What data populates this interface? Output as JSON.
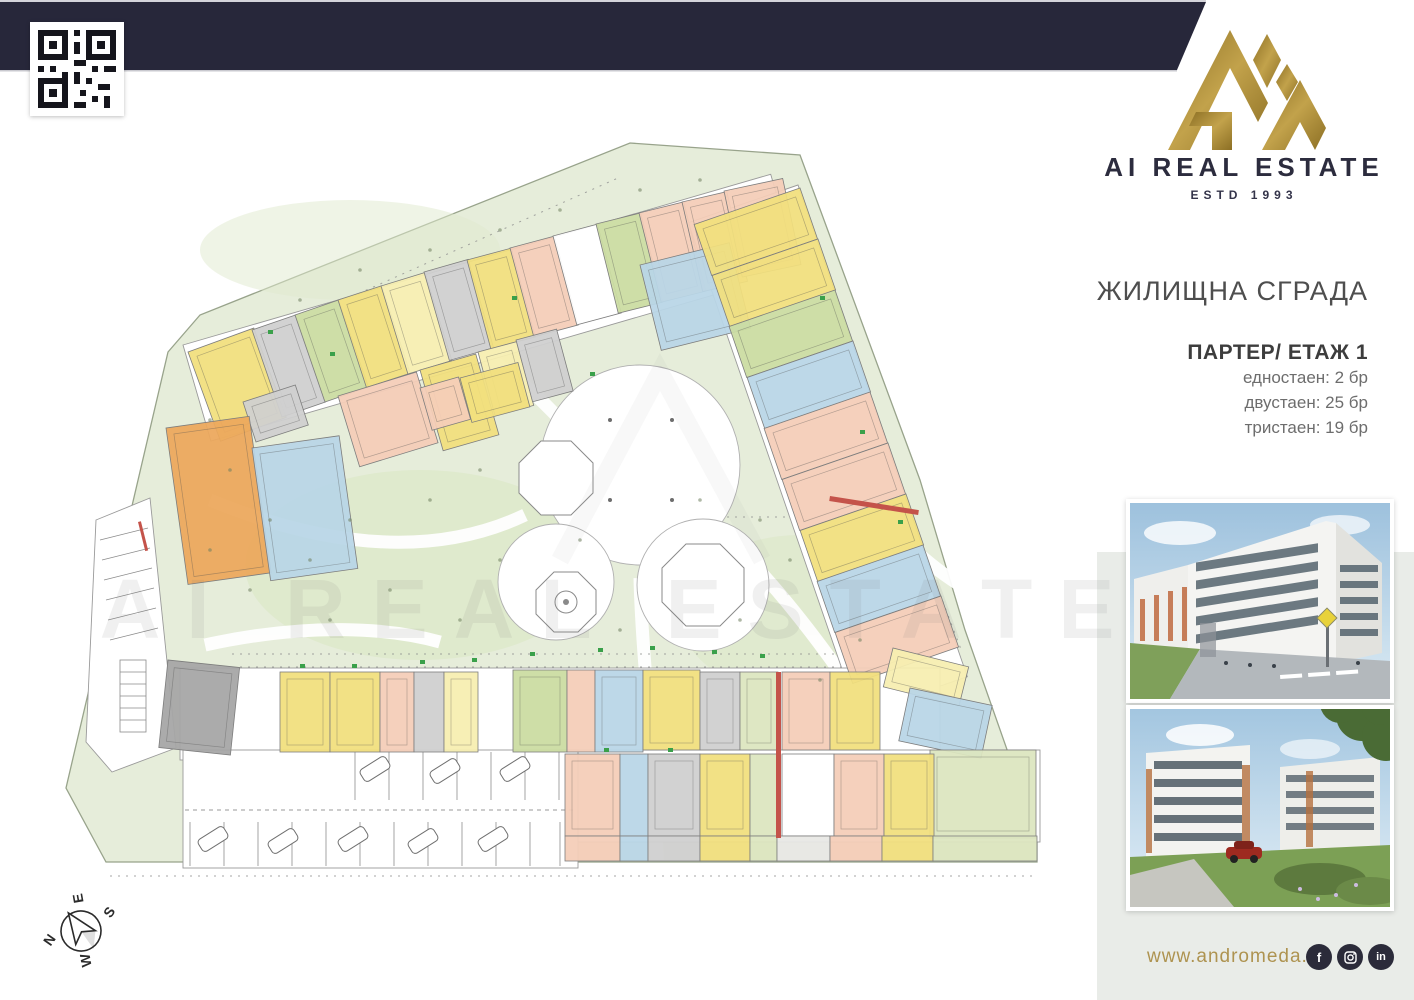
{
  "header": {
    "brand": "AI REAL ESTATE",
    "estd": "ESTD 1993"
  },
  "info": {
    "title": "ЖИЛИЩНА СГРАДА",
    "floor": "ПАРТЕР/ ЕТАЖ 1",
    "stats": [
      "едностаен: 2 бр",
      "двустаен: 25 бр",
      "тристаен: 19 бр"
    ]
  },
  "footer": {
    "url": "www.andromeda.bg",
    "social": [
      "facebook",
      "instagram",
      "linkedin"
    ]
  },
  "watermark": {
    "text": "AI REAL ESTATE"
  },
  "compass": {
    "n": "N",
    "e": "E",
    "s": "S",
    "w": "W"
  },
  "colors": {
    "navy": "#27273a",
    "gold": "#a5832f",
    "url_gold": "#ae9350",
    "site_green": "#e6edda",
    "yellow": "#f1df7d",
    "paleyellow": "#f7eeb0",
    "pink": "#f4cdb8",
    "blue": "#b9d6e7",
    "green": "#cbdca2",
    "palegreen": "#dce6bf",
    "orange": "#eca85c",
    "gray": "#cfcfcf",
    "darkgray": "#a6a6a6",
    "lightgray": "#e8e8e4",
    "white": "#ffffff",
    "red": "#c4534a",
    "mark": "#3aa04a"
  },
  "plan": {
    "units": [
      [
        188,
        352,
        70,
        95,
        -20,
        "yellow"
      ],
      [
        252,
        330,
        46,
        92,
        -19,
        "gray"
      ],
      [
        295,
        315,
        46,
        92,
        -19,
        "green"
      ],
      [
        338,
        300,
        46,
        92,
        -18,
        "yellow"
      ],
      [
        381,
        286,
        46,
        92,
        -17,
        "paleyellow"
      ],
      [
        424,
        272,
        46,
        92,
        -16,
        "gray"
      ],
      [
        467,
        260,
        46,
        92,
        -15,
        "yellow"
      ],
      [
        510,
        248,
        46,
        92,
        -15,
        "pink"
      ],
      [
        553,
        236,
        46,
        92,
        -15,
        "white"
      ],
      [
        596,
        224,
        46,
        92,
        -14,
        "green"
      ],
      [
        639,
        213,
        46,
        92,
        -14,
        "pink"
      ],
      [
        682,
        202,
        46,
        92,
        -13,
        "pink"
      ],
      [
        724,
        191,
        60,
        88,
        -12,
        "pink"
      ],
      [
        243,
        402,
        55,
        42,
        -18,
        "gray"
      ],
      [
        338,
        396,
        82,
        74,
        -17,
        "pink"
      ],
      [
        420,
        370,
        58,
        84,
        -16,
        "yellow"
      ],
      [
        478,
        352,
        40,
        66,
        -15,
        "paleyellow"
      ],
      [
        516,
        340,
        42,
        64,
        -15,
        "gray"
      ],
      [
        640,
        265,
        92,
        88,
        -14,
        "blue"
      ],
      [
        420,
        388,
        40,
        44,
        -16,
        "pink"
      ],
      [
        460,
        378,
        60,
        46,
        -15,
        "yellow"
      ],
      [
        166,
        428,
        84,
        158,
        -8,
        "orange"
      ],
      [
        252,
        448,
        88,
        134,
        -8,
        "blue"
      ],
      [
        168,
        660,
        72,
        88,
        6,
        "darkgray"
      ],
      [
        800,
        188,
        54,
        112,
        71,
        "yellow"
      ],
      [
        818,
        239,
        54,
        112,
        71,
        "yellow"
      ],
      [
        835,
        290,
        54,
        112,
        71,
        "green"
      ],
      [
        853,
        341,
        54,
        112,
        71,
        "blue"
      ],
      [
        870,
        392,
        54,
        112,
        71,
        "pink"
      ],
      [
        888,
        443,
        54,
        112,
        71,
        "pink"
      ],
      [
        906,
        494,
        54,
        112,
        71,
        "yellow"
      ],
      [
        923,
        545,
        54,
        112,
        71,
        "blue"
      ],
      [
        941,
        596,
        54,
        112,
        71,
        "pink"
      ],
      [
        893,
        648,
        78,
        40,
        14,
        "paleyellow"
      ],
      [
        910,
        688,
        84,
        54,
        12,
        "blue"
      ],
      [
        930,
        750,
        106,
        88,
        0,
        "palegreen"
      ],
      [
        280,
        672,
        50,
        80,
        0,
        "yellow"
      ],
      [
        330,
        672,
        50,
        80,
        0,
        "yellow"
      ],
      [
        380,
        672,
        34,
        80,
        0,
        "pink"
      ],
      [
        414,
        672,
        30,
        80,
        0,
        "gray"
      ],
      [
        444,
        672,
        34,
        80,
        0,
        "paleyellow"
      ],
      [
        513,
        670,
        54,
        82,
        0,
        "green"
      ],
      [
        567,
        670,
        28,
        82,
        0,
        "pink"
      ],
      [
        595,
        670,
        48,
        82,
        0,
        "blue"
      ],
      [
        643,
        670,
        57,
        80,
        0,
        "yellow"
      ],
      [
        700,
        672,
        40,
        78,
        0,
        "gray"
      ],
      [
        740,
        672,
        38,
        78,
        0,
        "palegreen"
      ],
      [
        782,
        672,
        48,
        78,
        0,
        "pink"
      ],
      [
        830,
        672,
        50,
        78,
        0,
        "yellow"
      ],
      [
        565,
        754,
        55,
        82,
        0,
        "pink"
      ],
      [
        620,
        754,
        28,
        82,
        0,
        "blue"
      ],
      [
        648,
        754,
        52,
        82,
        0,
        "gray"
      ],
      [
        700,
        754,
        50,
        82,
        0,
        "yellow"
      ],
      [
        750,
        754,
        27,
        82,
        0,
        "palegreen"
      ],
      [
        782,
        754,
        52,
        82,
        0,
        "white"
      ],
      [
        834,
        754,
        50,
        82,
        0,
        "pink"
      ],
      [
        884,
        754,
        50,
        82,
        0,
        "yellow"
      ],
      [
        565,
        836,
        55,
        25,
        0,
        "pink"
      ],
      [
        620,
        836,
        28,
        25,
        0,
        "blue"
      ],
      [
        648,
        836,
        52,
        25,
        0,
        "gray"
      ],
      [
        700,
        836,
        50,
        25,
        0,
        "yellow"
      ],
      [
        750,
        836,
        27,
        25,
        0,
        "palegreen"
      ],
      [
        777,
        836,
        53,
        25,
        0,
        "lightgray"
      ],
      [
        830,
        836,
        52,
        25,
        0,
        "pink"
      ],
      [
        882,
        836,
        51,
        25,
        0,
        "yellow"
      ],
      [
        933,
        836,
        104,
        25,
        0,
        "palegreen"
      ],
      [
        776,
        672,
        5,
        166,
        0,
        "red"
      ],
      [
        830,
        496,
        90,
        5,
        9,
        "red"
      ],
      [
        138,
        522,
        3,
        30,
        -14,
        "red"
      ],
      [
        300,
        664,
        5,
        4,
        0,
        "mark"
      ],
      [
        352,
        664,
        5,
        4,
        0,
        "mark"
      ],
      [
        420,
        660,
        5,
        4,
        0,
        "mark"
      ],
      [
        472,
        658,
        5,
        4,
        0,
        "mark"
      ],
      [
        530,
        652,
        5,
        4,
        0,
        "mark"
      ],
      [
        598,
        648,
        5,
        4,
        0,
        "mark"
      ],
      [
        650,
        646,
        5,
        4,
        0,
        "mark"
      ],
      [
        712,
        650,
        5,
        4,
        0,
        "mark"
      ],
      [
        760,
        654,
        5,
        4,
        0,
        "mark"
      ],
      [
        604,
        748,
        5,
        4,
        0,
        "mark"
      ],
      [
        668,
        748,
        5,
        4,
        0,
        "mark"
      ],
      [
        590,
        372,
        5,
        4,
        0,
        "mark"
      ],
      [
        512,
        296,
        5,
        4,
        0,
        "mark"
      ],
      [
        820,
        296,
        5,
        4,
        0,
        "mark"
      ],
      [
        860,
        430,
        5,
        4,
        0,
        "mark"
      ],
      [
        898,
        520,
        5,
        4,
        0,
        "mark"
      ],
      [
        330,
        352,
        5,
        4,
        0,
        "mark"
      ],
      [
        268,
        330,
        5,
        4,
        0,
        "mark"
      ]
    ]
  }
}
